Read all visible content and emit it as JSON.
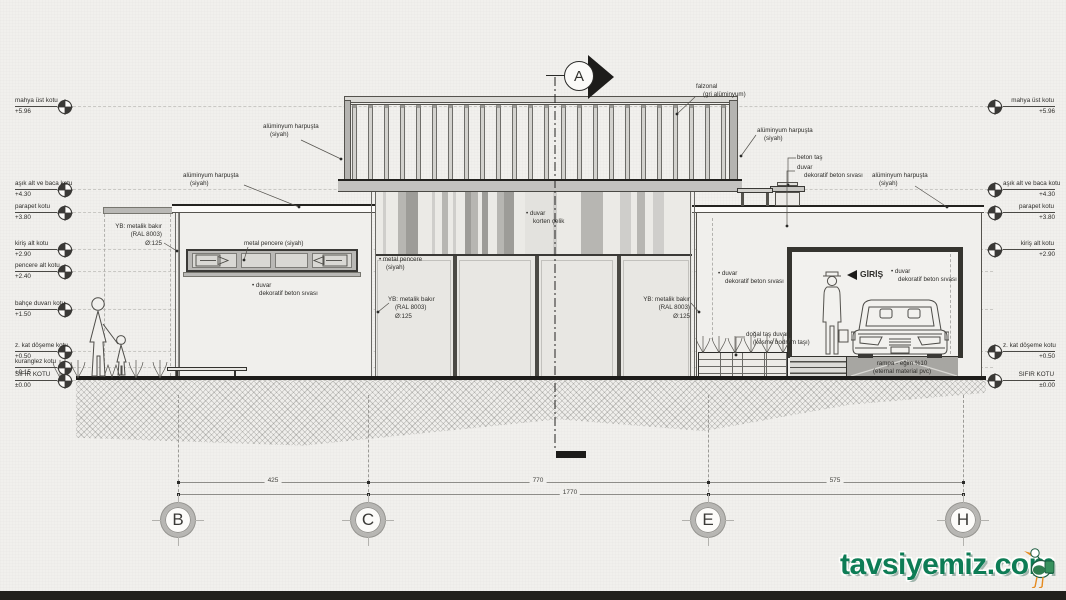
{
  "drawing": {
    "section_marker": "A",
    "watermark": {
      "text": "tavsiyemiz.com"
    },
    "colors": {
      "paper": "#f1f0ed",
      "ink": "#2a2a28",
      "mid": "#55534e",
      "dash": "#c9c8c4",
      "green": "#0d7c55",
      "stripe_a": "#e3e2de",
      "stripe_b": "#cfcecb",
      "stripe_c": "#b7b6b2",
      "stripe_d": "#9d9c98",
      "stripe_e": "#ebeae6"
    },
    "levels_left": [
      {
        "label": "mahya üst kotu",
        "value": "+5.96",
        "y": 107
      },
      {
        "label": "aşık alt ve baca kotu",
        "value": "+4.30",
        "y": 190
      },
      {
        "label": "parapet kotu",
        "value": "+3.80",
        "y": 213
      },
      {
        "label": "kiriş alt kotu",
        "value": "+2.90",
        "y": 250
      },
      {
        "label": "pencere alt kotu",
        "value": "+2.40",
        "y": 272
      },
      {
        "label": "bahçe duvarı kotu",
        "value": "+1.50",
        "y": 310
      },
      {
        "label": "z. kat döşeme kotu",
        "value": "+0.50",
        "y": 352
      },
      {
        "label": "kuranglez kotu",
        "value": "+0.15",
        "y": 368
      },
      {
        "label": "SIFIR KOTU",
        "value": "±0.00",
        "y": 381
      }
    ],
    "levels_right": [
      {
        "label": "mahya üst kotu",
        "value": "+5.96",
        "y": 107
      },
      {
        "label": "aşık alt ve baca kotu",
        "value": "+4.30",
        "y": 190
      },
      {
        "label": "parapet kotu",
        "value": "+3.80",
        "y": 213
      },
      {
        "label": "kiriş alt kotu",
        "value": "+2.90",
        "y": 250
      },
      {
        "label": "z. kat döşeme kotu",
        "value": "+0.50",
        "y": 352
      },
      {
        "label": "SIFIR KOTU",
        "value": "±0.00",
        "y": 381
      }
    ],
    "annotations": [
      {
        "id": "alum-harpusta-top-left",
        "x": 263,
        "y": 123,
        "lines": [
          "alüminyum harpuşta",
          "(siyah)"
        ],
        "leader": [
          [
            301,
            140
          ],
          [
            341,
            159
          ]
        ],
        "dot": 1
      },
      {
        "id": "falzonal",
        "x": 696,
        "y": 83,
        "lines": [
          "falzonal",
          "(gri alüminyum)"
        ],
        "leader": [
          [
            695,
            97
          ],
          [
            677,
            114
          ]
        ],
        "dot": 1
      },
      {
        "id": "alum-harpusta-left",
        "x": 183,
        "y": 172,
        "lines": [
          "alüminyum harpuşta",
          "(siyah)"
        ],
        "leader": [
          [
            244,
            185
          ],
          [
            299,
            207
          ]
        ],
        "dot": 1
      },
      {
        "id": "yb-bakir-left",
        "x": 112,
        "y": 223,
        "w": 50,
        "align": "right",
        "lines": [
          "YB: metalik bakır",
          "(RAL 8003)",
          "Ø:125"
        ],
        "leader": [
          [
            164,
            243
          ],
          [
            177,
            251
          ]
        ],
        "dot": 1
      },
      {
        "id": "metal-pencere-left",
        "x": 244,
        "y": 240,
        "lines": [
          "metal pencere (siyah)"
        ],
        "leader": [
          [
            248,
            247
          ],
          [
            244,
            260
          ]
        ],
        "dot": 1
      },
      {
        "id": "duvar-dekoratif-left",
        "x": 252,
        "y": 282,
        "lines": [
          "• duvar",
          "dekoratif beton sıvası"
        ]
      },
      {
        "id": "duvar-korten",
        "x": 526,
        "y": 210,
        "lines": [
          "• duvar",
          "korten çelik"
        ]
      },
      {
        "id": "metal-pencere-mid",
        "x": 379,
        "y": 256,
        "lines": [
          "• metal pencere",
          "(siyah)"
        ]
      },
      {
        "id": "yb-bakir-mid",
        "x": 388,
        "y": 296,
        "lines": [
          "YB: metalik bakır",
          "(RAL 8003)",
          "Ø:125"
        ],
        "leader": [
          [
            389,
            303
          ],
          [
            378,
            312
          ]
        ],
        "dot": 1
      },
      {
        "id": "yb-bakir-right",
        "x": 642,
        "y": 296,
        "w": 48,
        "align": "right",
        "lines": [
          "YB: metalik bakır",
          "(RAL 8003)",
          "Ø:125"
        ],
        "leader": [
          [
            691,
            303
          ],
          [
            699,
            312
          ]
        ],
        "dot": 1
      },
      {
        "id": "duvar-dekoratif-mid",
        "x": 718,
        "y": 270,
        "lines": [
          "• duvar",
          "dekoratif beton sıvası"
        ]
      },
      {
        "id": "dogal-tas",
        "x": 746,
        "y": 331,
        "lines": [
          "doğal taş duvar",
          "(kesme bodrum taşı)"
        ],
        "leader": [
          [
            745,
            337
          ],
          [
            736,
            337
          ],
          [
            736,
            355
          ]
        ],
        "dot": 1
      },
      {
        "id": "giris",
        "x": 860,
        "y": 269,
        "lines": [
          "GİRİŞ"
        ],
        "tri": 1,
        "bold": 1,
        "size": 8.5
      },
      {
        "id": "duvar-dekoratif-right",
        "x": 891,
        "y": 268,
        "lines": [
          "• duvar",
          "dekoratif beton sıvası"
        ]
      },
      {
        "id": "rampa",
        "x": 902,
        "y": 360,
        "align": "center",
        "lines": [
          "rampa - eğim %10",
          "(eternal material pvc)"
        ]
      },
      {
        "id": "alum-harpusta-roof",
        "x": 757,
        "y": 127,
        "lines": [
          "alüminyum harpuşta",
          "(siyah)"
        ],
        "leader": [
          [
            756,
            135
          ],
          [
            741,
            156
          ]
        ],
        "dot": 1
      },
      {
        "id": "beton-tas",
        "x": 797,
        "y": 154,
        "lines": [
          "beton taş"
        ],
        "leader": [
          [
            796,
            158
          ],
          [
            788,
            158
          ],
          [
            788,
            185
          ]
        ],
        "dot": 1
      },
      {
        "id": "duvar-dekoratif-baca",
        "x": 797,
        "y": 164,
        "lines": [
          "duvar",
          "dekoratif beton sıvası"
        ],
        "leader": [
          [
            795,
            171
          ],
          [
            787,
            171
          ],
          [
            787,
            226
          ]
        ],
        "dot": 1
      },
      {
        "id": "alum-harpusta-right",
        "x": 872,
        "y": 172,
        "lines": [
          "alüminyum harpuşta",
          "(siyah)"
        ],
        "leader": [
          [
            915,
            186
          ],
          [
            947,
            207
          ]
        ],
        "dot": 1
      }
    ],
    "grid": {
      "bubbles": [
        {
          "label": "B",
          "x": 178
        },
        {
          "label": "C",
          "x": 368
        },
        {
          "label": "E",
          "x": 708
        },
        {
          "label": "H",
          "x": 963
        }
      ],
      "segments": [
        {
          "value": "425",
          "x": 273
        },
        {
          "value": "770",
          "x": 538
        },
        {
          "value": "575",
          "x": 835
        }
      ],
      "total": {
        "value": "1770",
        "x": 570
      },
      "line1_y": 482,
      "line2_y": 494,
      "span": [
        178,
        963
      ],
      "bubble_y": 520
    },
    "facade": {
      "stripes": [
        [
          8,
          "e"
        ],
        [
          3,
          "b"
        ],
        [
          12,
          "e"
        ],
        [
          8,
          "c"
        ],
        [
          12,
          "d"
        ],
        [
          14,
          "e"
        ],
        [
          3,
          "b"
        ],
        [
          7,
          "e"
        ],
        [
          6,
          "c"
        ],
        [
          5,
          "e"
        ],
        [
          3,
          "b"
        ],
        [
          9,
          "e"
        ],
        [
          6,
          "d"
        ],
        [
          7,
          "c"
        ],
        [
          4,
          "e"
        ],
        [
          6,
          "d"
        ],
        [
          9,
          "e"
        ],
        [
          7,
          "c"
        ],
        [
          10,
          "d"
        ],
        [
          11,
          "e"
        ],
        [
          28,
          "a"
        ],
        [
          4,
          "b"
        ],
        [
          24,
          "e"
        ],
        [
          22,
          "c"
        ],
        [
          17,
          "e"
        ],
        [
          11,
          "b"
        ],
        [
          6,
          "e"
        ],
        [
          8,
          "c"
        ],
        [
          8,
          "e"
        ],
        [
          11,
          "b"
        ],
        [
          28,
          "e"
        ]
      ]
    },
    "railing": {
      "count": 24
    }
  }
}
